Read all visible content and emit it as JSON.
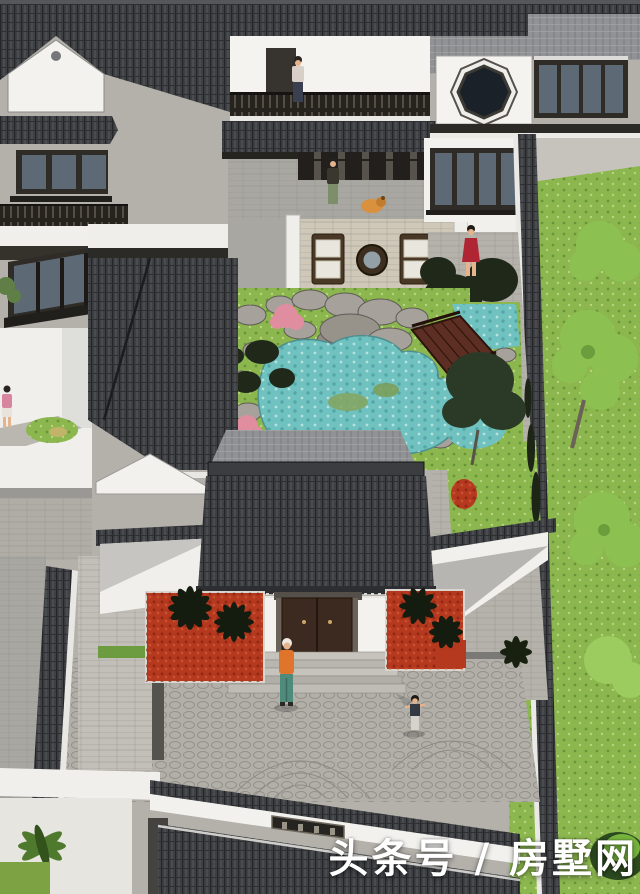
{
  "scene": {
    "description": "Aerial SketchUp-style rendering of a Chinese courtyard villa: tiled dark roofs, white walls, central rock pond with wooden bridge, stone courtyards, palm beds and lawns",
    "figures": [
      "person on upper balcony",
      "person with dog on roof terrace",
      "woman in red dress on side steps",
      "woman in orange top at main entrance",
      "child in front courtyard",
      "person on left walkway"
    ]
  },
  "watermark": {
    "text": "头条号 / 房墅网",
    "color": "#ffffff"
  },
  "palette": {
    "roof_dark": "#3e4043",
    "roof_light": "#919294",
    "wall_white": "#f3f2ee",
    "wood_dark": "#2f2b27",
    "door_brown": "#3c2a20",
    "bridge_brown": "#5d2f24",
    "water": "#6fc2bf",
    "lawn": "#8cb74f",
    "tree_bright": "#8cc152",
    "tree_dark": "#20281a",
    "flower_red": "#b5391f",
    "flower_pink": "#e08da0",
    "paving_gray": "#b2afa8",
    "terrace_tan": "#cfc8b8",
    "glass_blue": "#5d6a76"
  }
}
